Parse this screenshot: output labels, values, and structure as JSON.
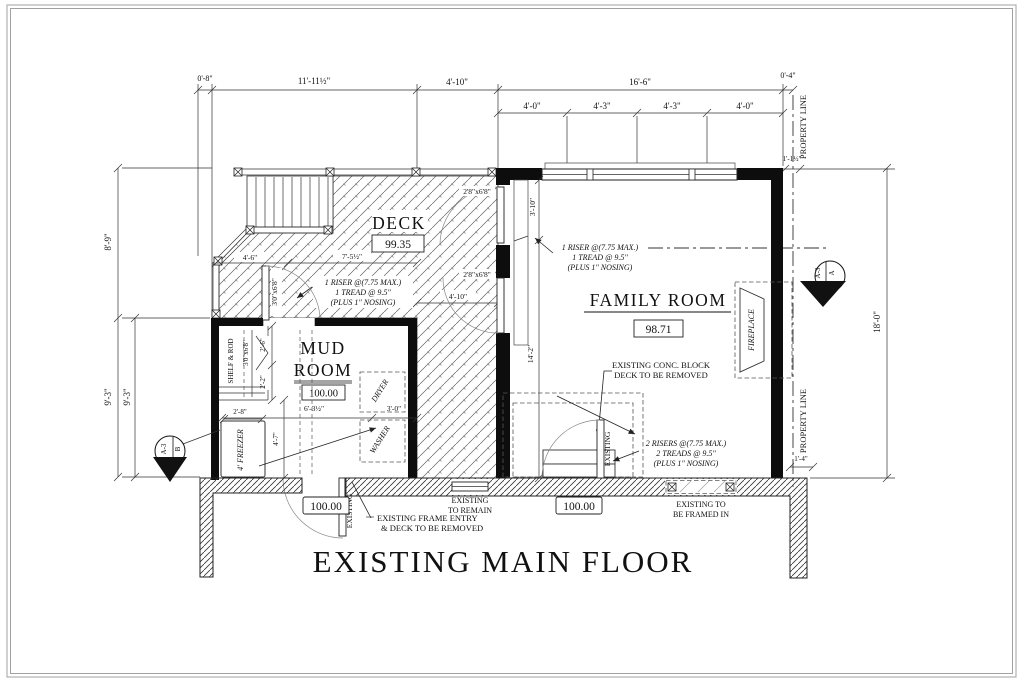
{
  "drawing": {
    "title": "EXISTING MAIN FLOOR"
  },
  "rooms": {
    "deck": {
      "label": "DECK",
      "elev": "99.35"
    },
    "mud": {
      "line1": "MUD",
      "line2": "ROOM",
      "elev": "100.00"
    },
    "family": {
      "label": "FAMILY ROOM",
      "elev": "98.71"
    },
    "fireplace": "FIREPLACE"
  },
  "levels": {
    "entry": "100.00",
    "patio": "100.00"
  },
  "dims": {
    "top1": [
      "0'-8\"",
      "11'-11½\"",
      "4'-10\"",
      "16'-6\"",
      "0'-4\""
    ],
    "top2": [
      "4'-0\"",
      "4'-3\"",
      "4'-3\"",
      "4'-0\""
    ],
    "top_corner": "1'-1½\"",
    "left": [
      "8'-9\"",
      "9'-3\"",
      "9'-3\""
    ],
    "right_height": "18'-0\"",
    "right_offset": "1'-4\"",
    "deck_edge": "4'-6\"",
    "deck_width": "7'-5½\"",
    "deck_lower": "4'-10\"",
    "landing": "3'-10\"",
    "family_depth": "14'-2\"",
    "mud_width": "6'-3½\"",
    "washer_w": "3'-0\"",
    "freezer_w": "2'-8\"",
    "mud_depth": "4'-7\"",
    "closet_door": "2'-6\"",
    "closet_side": "2'-2\""
  },
  "doors": {
    "deck_mud": "3'0\"x6'8\"",
    "closet": "3'0\"x6'8\"",
    "family_upper": "2'8\"x6'8\"",
    "family_lower": "2'8\"x6'8\""
  },
  "notes": {
    "riser1": [
      "1 RISER @(7.75 MAX.)",
      "1 TREAD @ 9.5\"",
      "(PLUS 1\" NOSING)"
    ],
    "riser2": [
      "1 RISER @(7.75 MAX.)",
      "1 TREAD @ 9.5\"",
      "(PLUS 1\" NOSING)"
    ],
    "riser3": [
      "2 RISERS @(7.75 MAX.)",
      "2 TREADS @ 9.5\"",
      "(PLUS 1\" NOSING)"
    ],
    "conc": [
      "EXISTING CONC. BLOCK",
      "DECK TO BE REMOVED"
    ],
    "remain": [
      "EXISTING",
      "TO REMAIN"
    ],
    "frame_entry": [
      "EXISTING FRAME ENTRY",
      "& DECK TO BE REMOVED"
    ],
    "framed_in": [
      "EXISTING TO",
      "BE FRAMED IN"
    ],
    "existing_door_family": "EXISTING",
    "existing_door_mud": "EXISTING",
    "shelf_rod": "SHELF & ROD",
    "freezer": "4' FREEZER",
    "dryer": "DRYER",
    "washer": "WASHER"
  },
  "site": {
    "property_line_top": "PROPERTY LINE",
    "property_line_bottom": "PROPERTY LINE"
  },
  "markers": {
    "a": {
      "letter": "A",
      "sheet": "A-3"
    },
    "b": {
      "letter": "B",
      "sheet": "A-3"
    }
  }
}
